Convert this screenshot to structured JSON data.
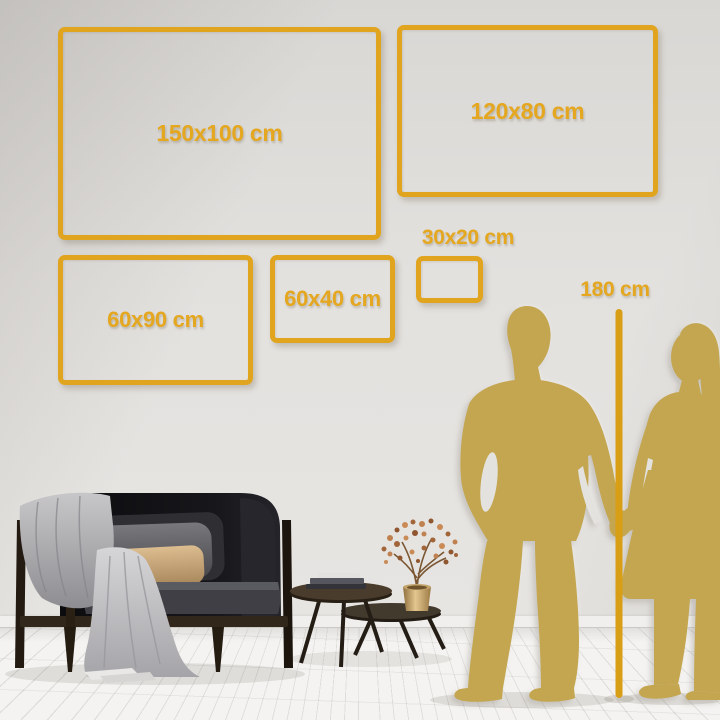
{
  "size_guide": {
    "boxes": [
      {
        "label": "150x100 cm"
      },
      {
        "label": "120x80 cm"
      },
      {
        "label": "60x90 cm"
      },
      {
        "label": "60x40 cm"
      },
      {
        "label": "30x20 cm"
      }
    ],
    "height_reference_label": "180 cm"
  },
  "colors": {
    "accent_gold": "#e4a71f",
    "ruler_gold": "#d89e15",
    "silhouette_gold": "#c3a64f",
    "wall": "#e3e1de",
    "floor": "#f3f2f0"
  }
}
